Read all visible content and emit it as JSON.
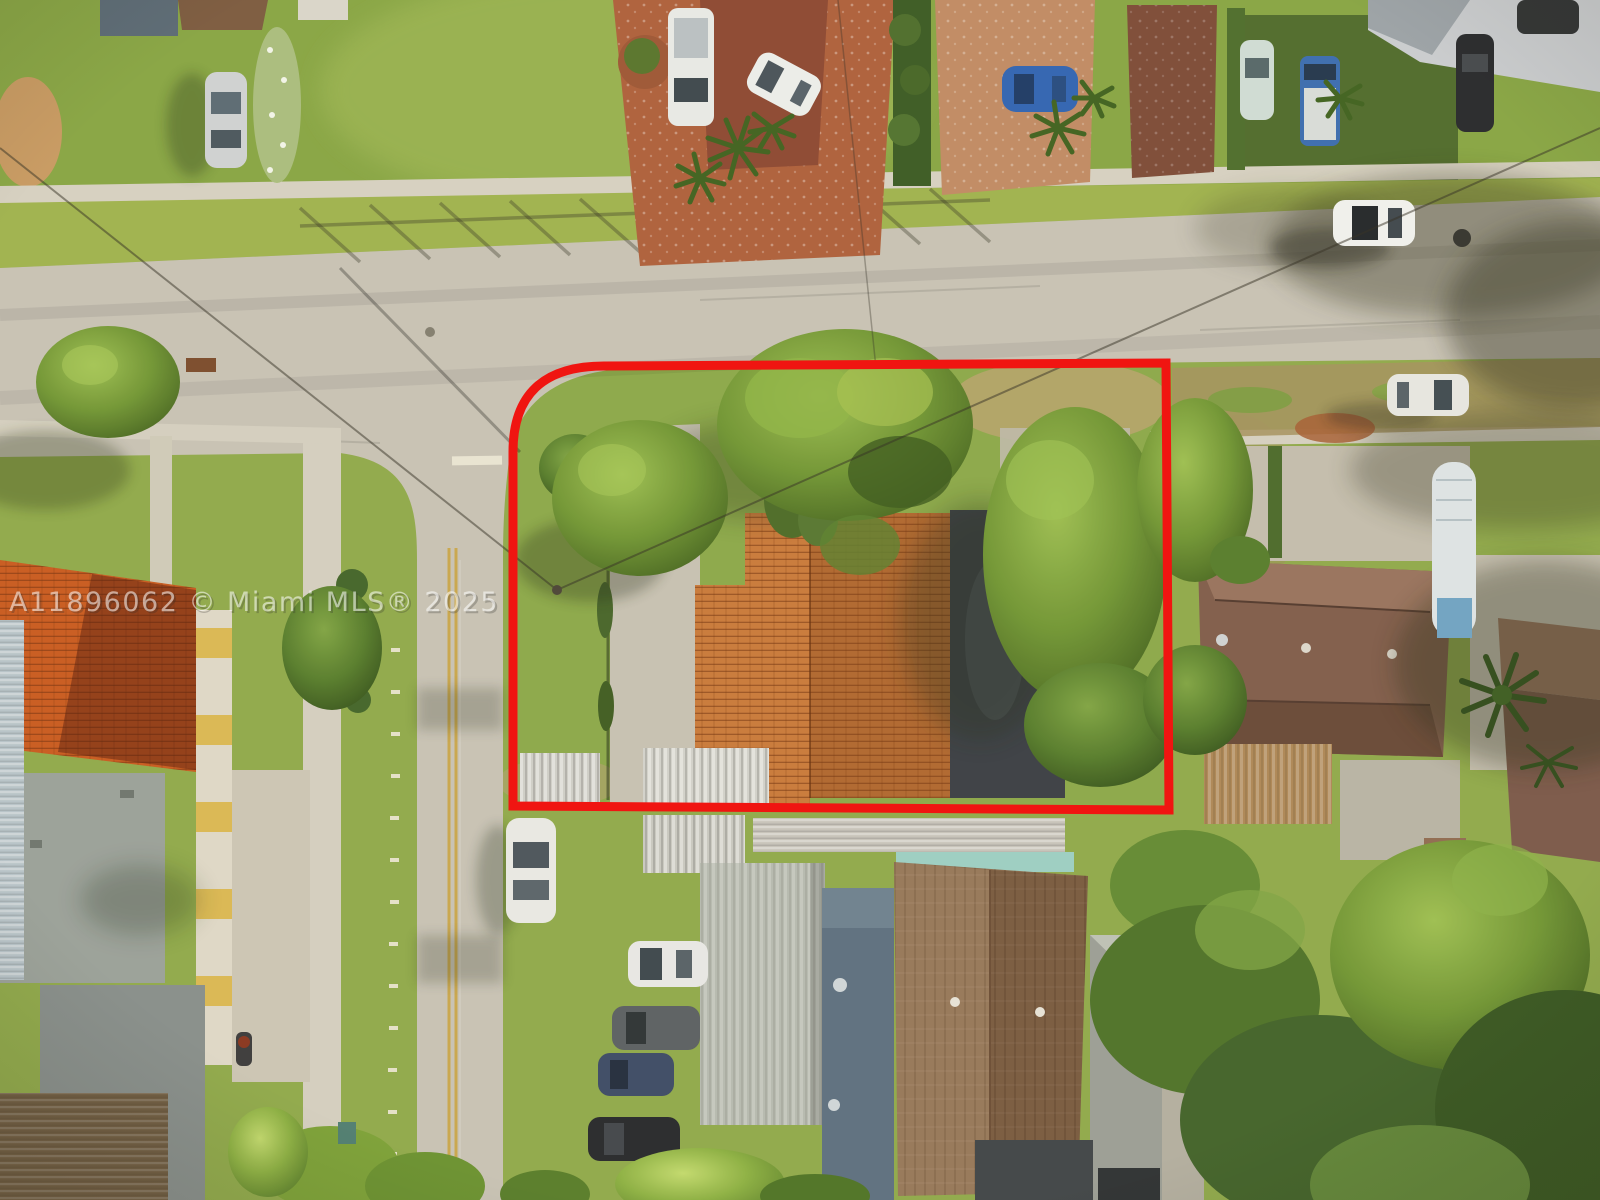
{
  "watermark": {
    "text": "A11896062 © Miami MLS® 2025"
  },
  "annotation": {
    "outline_color": "#f01511"
  },
  "palette": {
    "road": "#c7c2b6",
    "sidewalk": "#d6d1c3",
    "grass": "#8fa94b",
    "tile_roof": "#c8793b",
    "dark_roof": "#3a3e45",
    "metal_roof": "#b6bab1",
    "blue_roof": "#5c6f80",
    "shingle_roof": "#8a6a4e",
    "paver_driveway": "#ad5f3c"
  }
}
